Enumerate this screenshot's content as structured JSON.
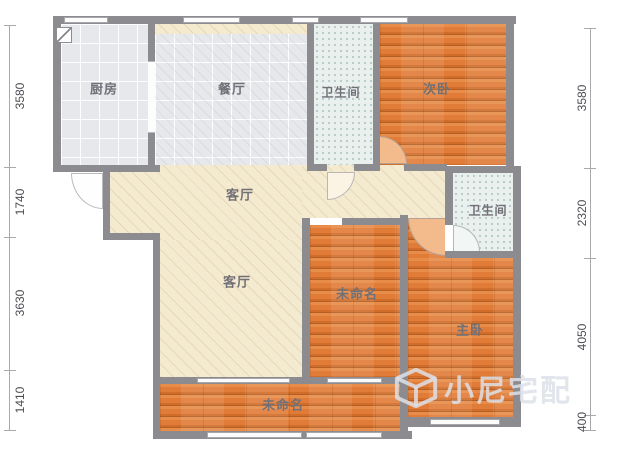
{
  "plan": {
    "title": "apartment-floor-plan",
    "rooms": {
      "kitchen": {
        "label": "厨房"
      },
      "dining": {
        "label": "餐厅"
      },
      "bath_top": {
        "label": "卫生间"
      },
      "bedroom2": {
        "label": "次卧"
      },
      "living_upper": {
        "label": "客厅"
      },
      "living": {
        "label": "客厅"
      },
      "room_mid": {
        "label": "未命名"
      },
      "bath_right": {
        "label": "卫生间"
      },
      "master": {
        "label": "主卧"
      },
      "balcony": {
        "label": "未命名"
      }
    },
    "dims": {
      "left": [
        "3580",
        "1740",
        "3630",
        "1410"
      ],
      "right": [
        "3580",
        "2320",
        "4050",
        "400"
      ]
    },
    "watermark": {
      "text": "小尼宅配",
      "icon": "cube-logo-icon"
    },
    "colors": {
      "wall": "#8b8b90",
      "wood_floor": "#e0813f",
      "living_floor": "#f4eacf",
      "tile_floor": "#e6e8ec",
      "bath_floor": "#e9f0ee"
    }
  }
}
